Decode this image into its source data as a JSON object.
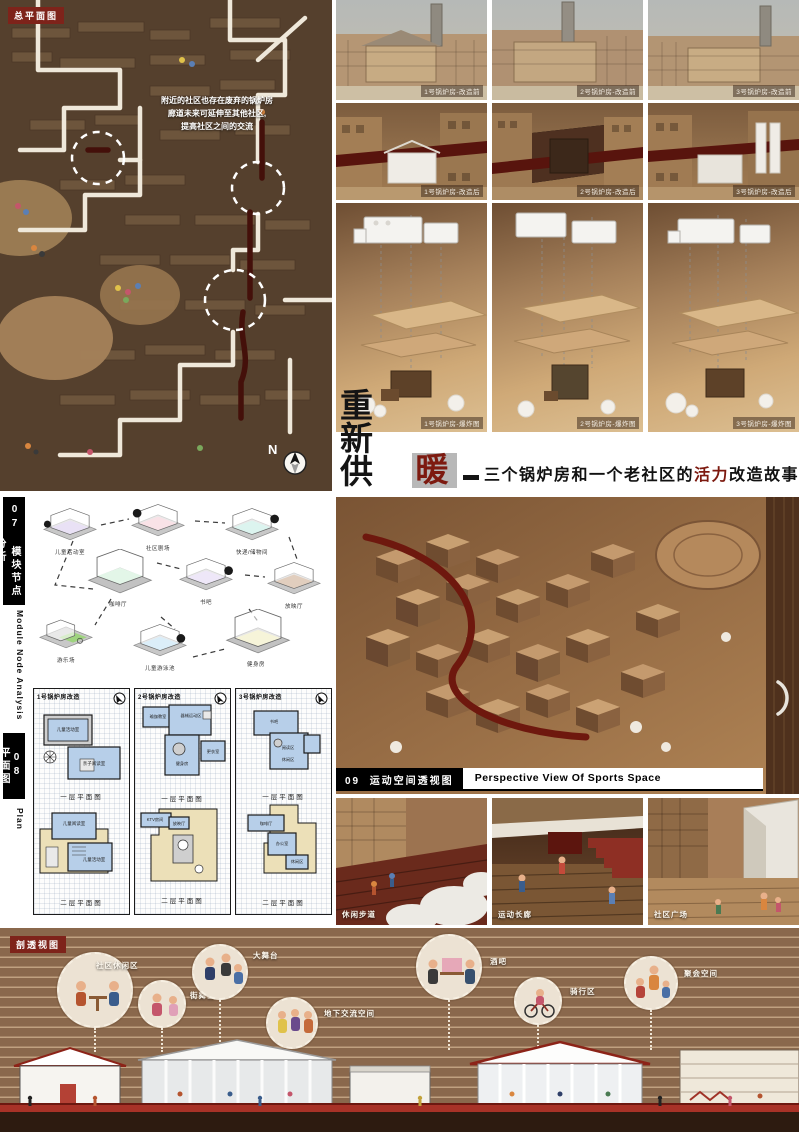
{
  "site_plan": {
    "tag": "总平面图",
    "note_line1": "附近的社区也存在废弃的锅炉房",
    "note_line2": "廊道未来可延伸至其他社区,",
    "note_line3": "提高社区之间的交流",
    "north_label": "N"
  },
  "photo_grid": {
    "before": [
      "1号锅炉房-改造前",
      "2号锅炉房-改造前",
      "3号锅炉房-改造前"
    ],
    "after": [
      "1号锅炉房-改造后",
      "2号锅炉房-改造后",
      "3号锅炉房-改造后"
    ],
    "exploded": [
      "1号锅炉房-爆炸图",
      "2号锅炉房-爆炸图",
      "3号锅炉房-爆炸图"
    ]
  },
  "title": {
    "main": "重新供",
    "highlight": "暖",
    "sub_pre": "三个锅炉房和一个老社区的",
    "sub_accent": "活力",
    "sub_post": "改造故事"
  },
  "sidebar": {
    "s07": "07 模块节点分析",
    "s07_en": "Module Node Analysis",
    "s08": "08 平面图",
    "s08_en": "Plan"
  },
  "modules": {
    "m1": "儿童活动室",
    "m2": "社区剧场",
    "m3": "快递/储物间",
    "m4": "咖啡厅",
    "m5": "书吧",
    "m6": "放映厅",
    "m7": "游乐场",
    "m8": "儿童游泳池",
    "m9": "健身房"
  },
  "plans": {
    "col1": {
      "title": "1号锅炉房改造",
      "f1_caption": "一层平面图",
      "f2_caption": "二层平面图",
      "f1_room1": "儿童活动室",
      "f1_room2": "亲子阅读室",
      "f2_room1": "儿童阅读室",
      "f2_room2": "儿童活动室"
    },
    "col2": {
      "title": "2号锅炉房改造",
      "f1_caption": "一层平面图",
      "f2_caption": "二层平面图",
      "f1_room1": "瑜伽教室",
      "f1_room2": "器械运动区",
      "f1_room3": "健身房",
      "f1_room4": "更衣室",
      "f2_room1": "KTV房间",
      "f2_room2": "放映厅"
    },
    "col3": {
      "title": "3号锅炉房改造",
      "f1_caption": "一层平面图",
      "f2_caption": "二层平面图",
      "f1_room1": "书吧",
      "f1_room2": "阅读区",
      "f1_room3": "休闲区",
      "f2_room1": "咖啡厅",
      "f2_room2": "办公室",
      "f2_room3": "休闲区"
    }
  },
  "sports": {
    "num": "09",
    "cn": "运动空间透视图",
    "en": "Perspective View Of Sports Space"
  },
  "renders": {
    "r1": "休闲步道",
    "r2": "运动长廊",
    "r3": "社区广场"
  },
  "section_view": {
    "tag": "剖透视图",
    "b1": "社区休闲区",
    "b2": "街舞区",
    "b3": "大舞台",
    "b4": "地下交流空间",
    "b5": "酒吧",
    "b6": "骑行区",
    "b7": "聚会空间"
  }
}
